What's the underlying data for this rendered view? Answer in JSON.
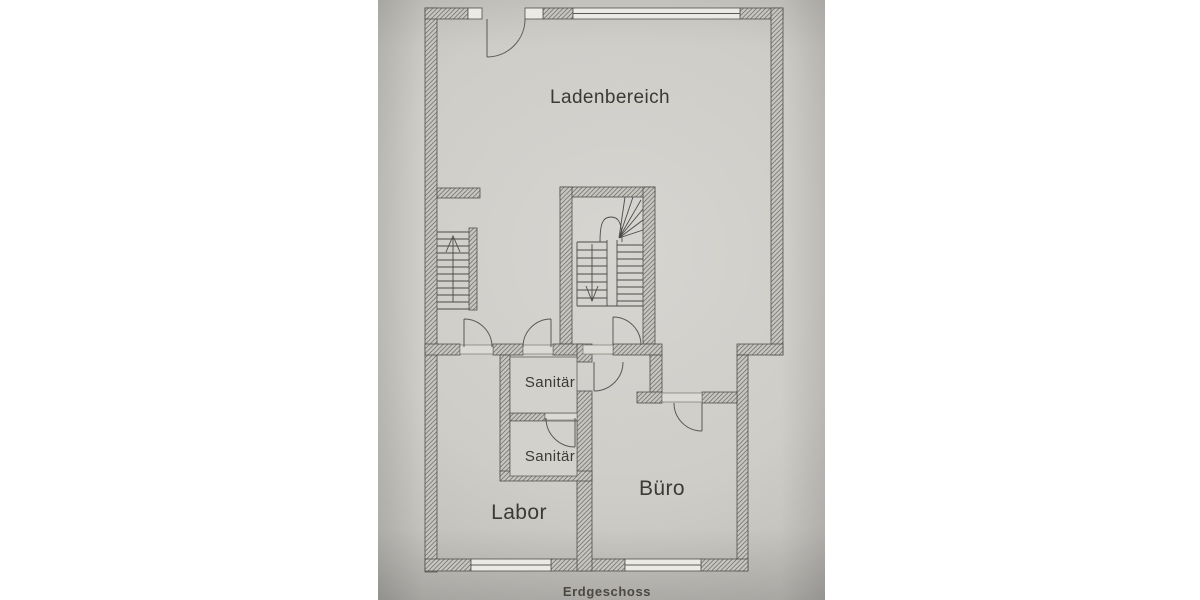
{
  "floorplan": {
    "caption": "Erdgeschoss",
    "rooms": [
      {
        "label": "Ladenbereich"
      },
      {
        "label": "Sanitär"
      },
      {
        "label": "Sanitär"
      },
      {
        "label": "Labor"
      },
      {
        "label": "Büro"
      }
    ],
    "colors": {
      "paper": "#cfcdc8",
      "page_background": "#ffffff",
      "wall_line": "#504f4b",
      "hatch_line": "#6f6d68",
      "room_text": "#3b3a37",
      "caption_text": "#4c4841"
    }
  }
}
